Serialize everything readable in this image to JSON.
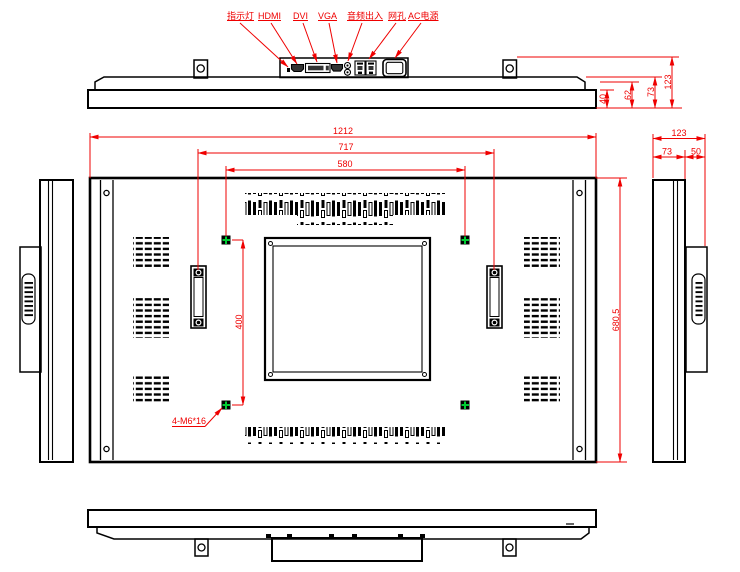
{
  "drawing": {
    "colors": {
      "line": "#000000",
      "dimension_red": "#ef0000",
      "vesa_green": "#00cc33",
      "background": "#ffffff"
    },
    "top_view": {
      "port_labels": [
        "指示灯",
        "HDMI",
        "DVI",
        "VGA",
        "音频出入",
        "网孔",
        "AC电源"
      ],
      "dims": {
        "step1": "40",
        "step2": "62",
        "body_depth": "73",
        "total_depth": "123"
      }
    },
    "back_view": {
      "dims": {
        "overall_width": "1212",
        "handle_span": "717",
        "vesa_width": "580",
        "overall_height": "680,5",
        "vesa_height": "400"
      },
      "mount_note": "4-M6*16"
    },
    "side_view": {
      "dims": {
        "total_depth": "123",
        "front_depth": "73",
        "rear_depth": "50"
      }
    }
  }
}
